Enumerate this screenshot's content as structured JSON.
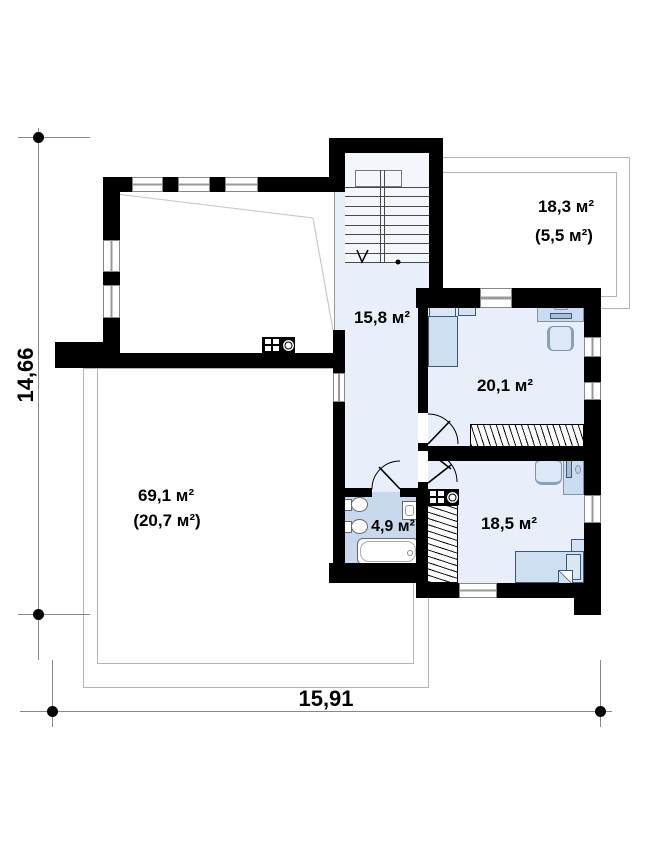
{
  "plan": {
    "type": "second-floor plan drawing",
    "dimensions": {
      "vertical_total": "14,66",
      "horizontal_total": "15,91"
    },
    "rooms": {
      "terrace_upper": {
        "area": "18,3 м²",
        "area_note": "(5,5 м²)"
      },
      "hall": {
        "area": "15,8 м²"
      },
      "bedroom_top": {
        "area": "20,1 м²"
      },
      "bedroom_bottom": {
        "area": "18,5 м²"
      },
      "bathroom": {
        "area": "4,9 м²"
      },
      "void_below": {
        "area": "69,1 м²",
        "area_note": "(20,7 м²)"
      }
    },
    "icons": {
      "cooktop_main": "cooktop-icon",
      "cooktop_small": "cooktop-icon",
      "stair_direction": "stair-arrow-icon"
    },
    "colors": {
      "wall": "#000000",
      "room_floor": "#e9effa",
      "stair_floor": "#f3f7fc",
      "bathroom_floor": "#c9d9ed",
      "furniture_fill": "#cfdff2",
      "terrace_outline": "#b4b4b4"
    }
  }
}
